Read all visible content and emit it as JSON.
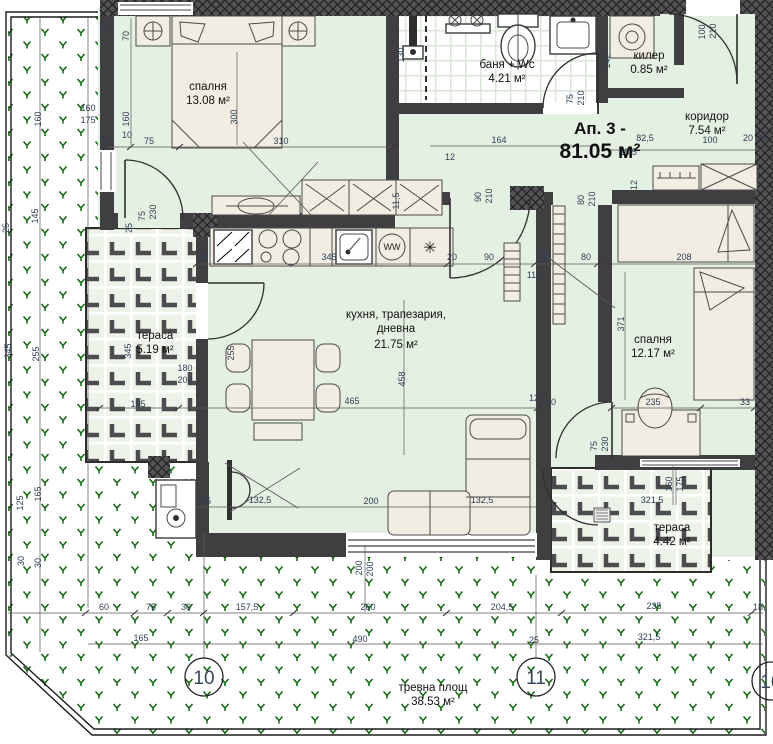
{
  "title": {
    "line1": "Ап. 3 -",
    "line2": "81.05 м²"
  },
  "rooms": [
    {
      "id": "bedroom-1",
      "label": "спалня",
      "area": "13.08 м²",
      "x": 208,
      "y": 90
    },
    {
      "id": "bathroom",
      "label": "баня + Wc",
      "area": "4.21 м²",
      "x": 507,
      "y": 68
    },
    {
      "id": "closet",
      "label": "килер",
      "area": "0.85 м²",
      "x": 649,
      "y": 59
    },
    {
      "id": "corridor",
      "label": "коридор",
      "area": "7.54 м²",
      "x": 707,
      "y": 120
    },
    {
      "id": "living",
      "label": "кухня, трапезария,",
      "label2": "дневна",
      "area": "21.75 м²",
      "x": 396,
      "y": 318
    },
    {
      "id": "bedroom-2",
      "label": "спалня",
      "area": "12.17 м²",
      "x": 653,
      "y": 343
    },
    {
      "id": "terrace-west",
      "label": "тераса",
      "area": "5.19 м²",
      "x": 155,
      "y": 339
    },
    {
      "id": "terrace-south",
      "label": "тераса",
      "area": "4.42 м²",
      "x": 672,
      "y": 531
    },
    {
      "id": "lawn",
      "label": "тревна площ",
      "area": "38.53 м²",
      "x": 433,
      "y": 691
    }
  ],
  "markers": [
    {
      "label": "10",
      "x": 204,
      "y": 677
    },
    {
      "label": "11",
      "x": 536,
      "y": 677
    },
    {
      "label": "10",
      "x": 771,
      "y": 681
    }
  ],
  "icons": {
    "washer_label": "WW",
    "dishwasher_symbol": "✳"
  },
  "colors": {
    "floor": "#e4f0e1",
    "wall": "#3f3f41",
    "lawn_green": "#1a6a1a",
    "furniture": "#f2ede3",
    "dim_text": "#2e3f55"
  },
  "dimensions": [
    {
      "t": "25",
      "x": 107,
      "y": 27,
      "r": 1
    },
    {
      "t": "70",
      "x": 129,
      "y": 36,
      "r": 1
    },
    {
      "t": "160",
      "x": 129,
      "y": 119,
      "r": 1
    },
    {
      "t": "5",
      "x": 103,
      "y": 144
    },
    {
      "t": "10",
      "x": 127,
      "y": 138
    },
    {
      "t": "75",
      "x": 149,
      "y": 144
    },
    {
      "t": "310",
      "x": 281,
      "y": 144
    },
    {
      "t": "300",
      "x": 237,
      "y": 117,
      "r": 1
    },
    {
      "t": "75",
      "x": 145,
      "y": 216,
      "r": 1
    },
    {
      "t": "230",
      "x": 156,
      "y": 212,
      "r": 1
    },
    {
      "t": "25",
      "x": 132,
      "y": 228,
      "r": 1
    },
    {
      "t": "130",
      "x": 404,
      "y": 55,
      "r": 1
    },
    {
      "t": "164",
      "x": 499,
      "y": 143
    },
    {
      "t": "75",
      "x": 573,
      "y": 99,
      "r": 1
    },
    {
      "t": "210",
      "x": 584,
      "y": 98,
      "r": 1
    },
    {
      "t": "100",
      "x": 705,
      "y": 32,
      "r": 1
    },
    {
      "t": "210",
      "x": 716,
      "y": 31,
      "r": 1
    },
    {
      "t": "142",
      "x": 610,
      "y": 61,
      "r": 1
    },
    {
      "t": "82,5",
      "x": 645,
      "y": 141
    },
    {
      "t": "100",
      "x": 710,
      "y": 143
    },
    {
      "t": "20",
      "x": 748,
      "y": 141
    },
    {
      "t": "25",
      "x": 762,
      "y": 141
    },
    {
      "t": "18,5",
      "x": 628,
      "y": 155
    },
    {
      "t": "90",
      "x": 481,
      "y": 197,
      "r": 1
    },
    {
      "t": "210",
      "x": 492,
      "y": 196,
      "r": 1
    },
    {
      "t": "80",
      "x": 584,
      "y": 200,
      "r": 1
    },
    {
      "t": "210",
      "x": 595,
      "y": 199,
      "r": 1
    },
    {
      "t": "12",
      "x": 450,
      "y": 160
    },
    {
      "t": "112",
      "x": 534,
      "y": 278
    },
    {
      "t": "11,5",
      "x": 399,
      "y": 201,
      "r": 1
    },
    {
      "t": "25",
      "x": 203,
      "y": 260
    },
    {
      "t": "345",
      "x": 329,
      "y": 260
    },
    {
      "t": "20",
      "x": 452,
      "y": 260
    },
    {
      "t": "90",
      "x": 489,
      "y": 260
    },
    {
      "t": "40",
      "x": 546,
      "y": 260
    },
    {
      "t": "80",
      "x": 586,
      "y": 260
    },
    {
      "t": "208",
      "x": 684,
      "y": 260
    },
    {
      "t": "12",
      "x": 637,
      "y": 185,
      "r": 1
    },
    {
      "t": "371",
      "x": 624,
      "y": 324,
      "r": 1
    },
    {
      "t": "235",
      "x": 653,
      "y": 405
    },
    {
      "t": "33",
      "x": 745,
      "y": 405
    },
    {
      "t": "60",
      "x": 551,
      "y": 405
    },
    {
      "t": "12",
      "x": 534,
      "y": 401
    },
    {
      "t": "75",
      "x": 597,
      "y": 446,
      "r": 1
    },
    {
      "t": "230",
      "x": 608,
      "y": 444,
      "r": 1
    },
    {
      "t": "465",
      "x": 352,
      "y": 404
    },
    {
      "t": "458",
      "x": 405,
      "y": 379,
      "r": 1
    },
    {
      "t": "255",
      "x": 234,
      "y": 353,
      "r": 1
    },
    {
      "t": "180",
      "x": 185,
      "y": 371
    },
    {
      "t": "200",
      "x": 185,
      "y": 383
    },
    {
      "t": "155",
      "x": 138,
      "y": 407
    },
    {
      "t": "345",
      "x": 131,
      "y": 351,
      "r": 1
    },
    {
      "t": "25",
      "x": 206,
      "y": 504
    },
    {
      "t": "132,5",
      "x": 260,
      "y": 503
    },
    {
      "t": "200",
      "x": 371,
      "y": 504
    },
    {
      "t": "132,5",
      "x": 482,
      "y": 503
    },
    {
      "t": "160",
      "x": 88,
      "y": 111
    },
    {
      "t": "175",
      "x": 88,
      "y": 123
    },
    {
      "t": "160",
      "x": 41,
      "y": 119,
      "r": 1
    },
    {
      "t": "145",
      "x": 38,
      "y": 216,
      "r": 1
    },
    {
      "t": "25",
      "x": 9,
      "y": 228,
      "r": 1
    },
    {
      "t": "345",
      "x": 11,
      "y": 351,
      "r": 1
    },
    {
      "t": "255",
      "x": 39,
      "y": 354,
      "r": 1
    },
    {
      "t": "125",
      "x": 23,
      "y": 503,
      "r": 1
    },
    {
      "t": "165",
      "x": 41,
      "y": 494,
      "r": 1
    },
    {
      "t": "30",
      "x": 24,
      "y": 561,
      "r": 1
    },
    {
      "t": "30",
      "x": 41,
      "y": 563,
      "r": 1
    },
    {
      "t": "60",
      "x": 104,
      "y": 610
    },
    {
      "t": "75",
      "x": 151,
      "y": 610
    },
    {
      "t": "30",
      "x": 186,
      "y": 610
    },
    {
      "t": "157,5",
      "x": 247,
      "y": 610
    },
    {
      "t": "260",
      "x": 368,
      "y": 610
    },
    {
      "t": "204,5",
      "x": 502,
      "y": 610
    },
    {
      "t": "235",
      "x": 654,
      "y": 609
    },
    {
      "t": "18",
      "x": 758,
      "y": 610
    },
    {
      "t": "165",
      "x": 141,
      "y": 641
    },
    {
      "t": "490",
      "x": 360,
      "y": 642
    },
    {
      "t": "25",
      "x": 534,
      "y": 643
    },
    {
      "t": "321,5",
      "x": 649,
      "y": 640
    },
    {
      "t": "200",
      "x": 362,
      "y": 568,
      "r": 1
    },
    {
      "t": "200",
      "x": 373,
      "y": 569,
      "r": 1
    },
    {
      "t": "321,5",
      "x": 652,
      "y": 503
    },
    {
      "t": "160",
      "x": 672,
      "y": 484,
      "r": 1
    },
    {
      "t": "175",
      "x": 683,
      "y": 484,
      "r": 1
    }
  ]
}
